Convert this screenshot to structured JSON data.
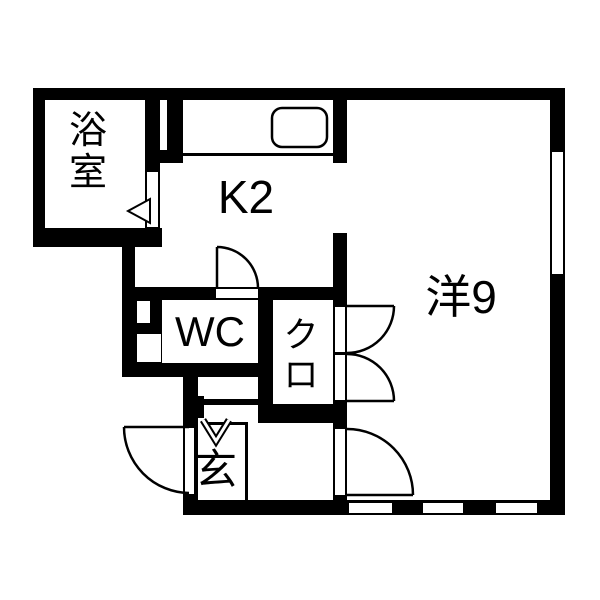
{
  "floorplan": {
    "background_color": "#ffffff",
    "wall_color": "#000000",
    "rooms": [
      {
        "id": "bathroom",
        "label": "浴室",
        "orientation": "vertical"
      },
      {
        "id": "kitchen",
        "label": "K2",
        "orientation": "horizontal"
      },
      {
        "id": "western_room",
        "label": "洋9",
        "orientation": "horizontal"
      },
      {
        "id": "toilet",
        "label": "WC",
        "orientation": "horizontal"
      },
      {
        "id": "closet",
        "label": "クロ",
        "orientation": "vertical"
      },
      {
        "id": "entrance",
        "label": "玄",
        "orientation": "horizontal"
      }
    ]
  }
}
